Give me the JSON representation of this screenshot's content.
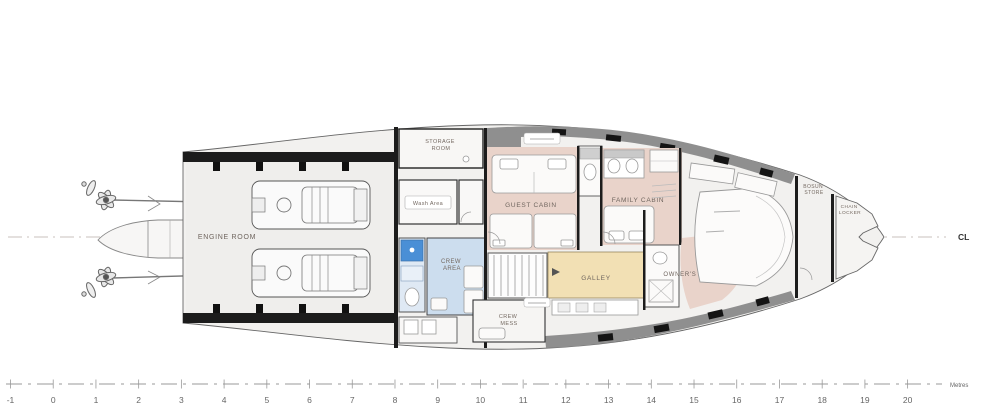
{
  "drawing": {
    "type": "yacht lower deck general arrangement plan",
    "orientation": "bow right, stern left"
  },
  "centerline": {
    "label": "CL"
  },
  "scale_bar": {
    "tick_labels": [
      "-1",
      "0",
      "1",
      "2",
      "3",
      "4",
      "5",
      "6",
      "7",
      "8",
      "9",
      "10",
      "11",
      "12",
      "13",
      "14",
      "15",
      "16",
      "17",
      "18",
      "19",
      "20"
    ],
    "unit_label": "Metres"
  },
  "rooms": {
    "engine_room": {
      "label": "ENGINE ROOM"
    },
    "storage_room": {
      "lines": [
        "STORAGE",
        "ROOM"
      ]
    },
    "wash_area": {
      "label": "Wash Area"
    },
    "crew_area": {
      "lines": [
        "CREW",
        "AREA"
      ]
    },
    "crew_mess": {
      "lines": [
        "CREW",
        "MESS"
      ]
    },
    "guest_cabin": {
      "label": "GUEST CABIN"
    },
    "family_cabin": {
      "label": "FAMILY CABIN"
    },
    "galley": {
      "label": "GALLEY"
    },
    "owners_cabin": {
      "label": "OWNER'S CABIN"
    },
    "bosun_store": {
      "lines": [
        "BOSUN",
        "STORE"
      ]
    },
    "chain_locker": {
      "lines": [
        "CHAIN",
        "LOCKER"
      ]
    }
  },
  "colors": {
    "cabin_pink": "#e9d3ca",
    "galley_yellow": "#f2e0b4",
    "crew_blue": "#ccddee",
    "fixture_blue": "#4a8fd6",
    "hull_gray": "#f2f1ef",
    "band_gray": "#8f8f8f",
    "wall_black": "#1c1c1c"
  }
}
